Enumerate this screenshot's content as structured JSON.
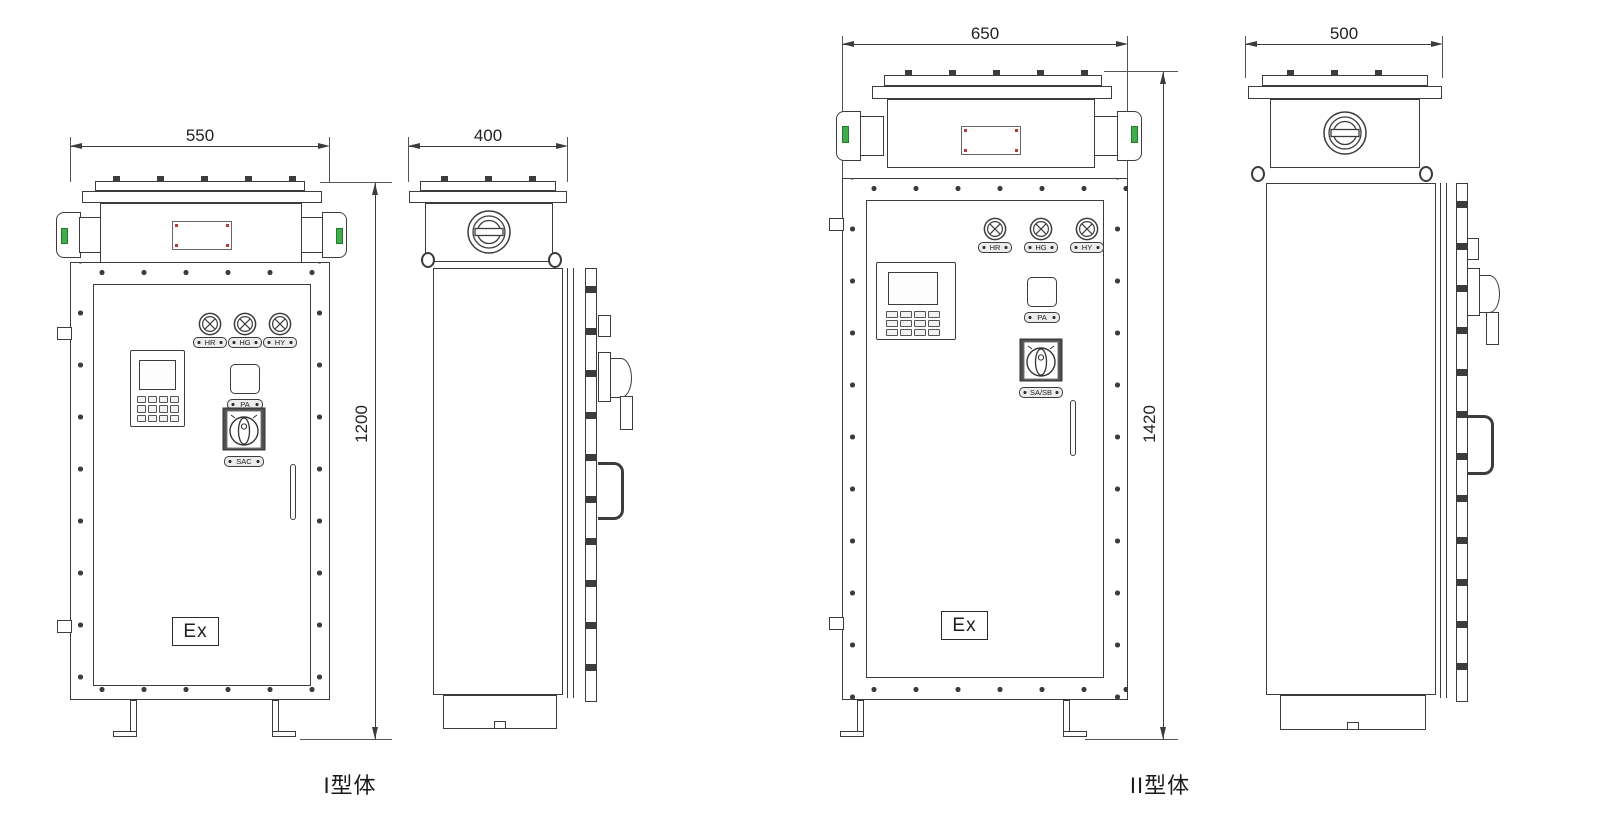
{
  "type_I": {
    "caption": "I型体",
    "front": {
      "width_dim": "550",
      "height_dim": "1200",
      "indicator_lights": [
        "HR",
        "HG",
        "HY"
      ],
      "button_label": "PA",
      "switch_label": "SAC",
      "ex_mark": "Ex"
    },
    "side": {
      "depth_dim": "400"
    }
  },
  "type_II": {
    "caption": "II型体",
    "front": {
      "width_dim": "650",
      "height_dim": "1420",
      "indicator_lights": [
        "HR",
        "HG",
        "HY"
      ],
      "button_label": "PA",
      "switch_label": "SA/SB",
      "ex_mark": "Ex"
    },
    "side": {
      "depth_dim": "500"
    }
  },
  "colors": {
    "line": "#3c3c3c",
    "seal_green": "#3fae49",
    "rivet_red": "#b33a3a",
    "switch_body": "#4f4f4f"
  }
}
